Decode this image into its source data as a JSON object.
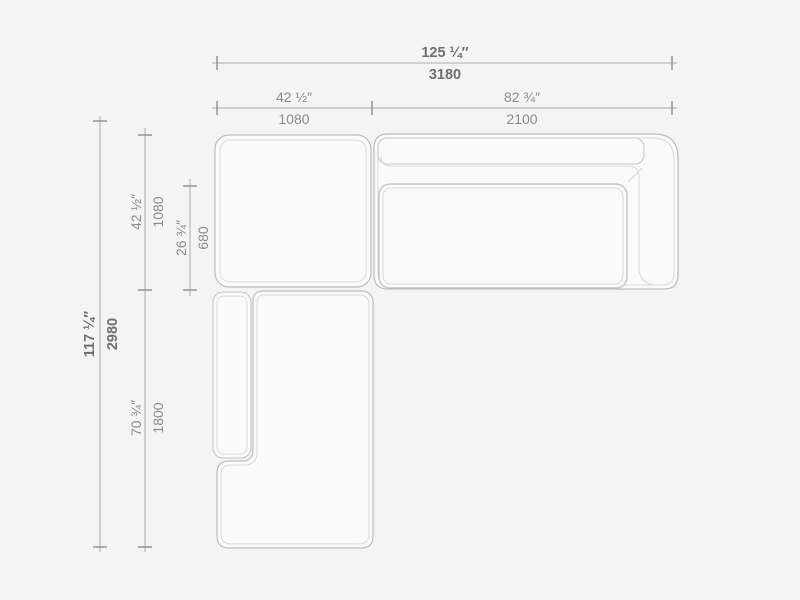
{
  "dimensions": {
    "overall_width": {
      "inches": "125 ¼″",
      "mm": "3180"
    },
    "left_section_width": {
      "inches": "42 ½″",
      "mm": "1080"
    },
    "right_section_width": {
      "inches": "82 ¾″",
      "mm": "2100"
    },
    "overall_depth": {
      "inches": "117 ¼″",
      "mm": "2980"
    },
    "top_section_depth": {
      "inches": "42 ½″",
      "mm": "1080"
    },
    "seat_depth": {
      "inches": "26 ¾″",
      "mm": "680"
    },
    "chaise_length": {
      "inches": "70 ¾″",
      "mm": "1800"
    }
  },
  "colors": {
    "background": "#f4f4f4",
    "module_fill": "#fafafa",
    "outline": "#bdbdbd",
    "inner_line": "#d9d9d9",
    "cushion_line": "#c6c6c6",
    "dim_line": "#ababab",
    "tick": "#8f8f8f",
    "text_primary": "#6e6e6e",
    "text_secondary": "#8a8a8a"
  }
}
